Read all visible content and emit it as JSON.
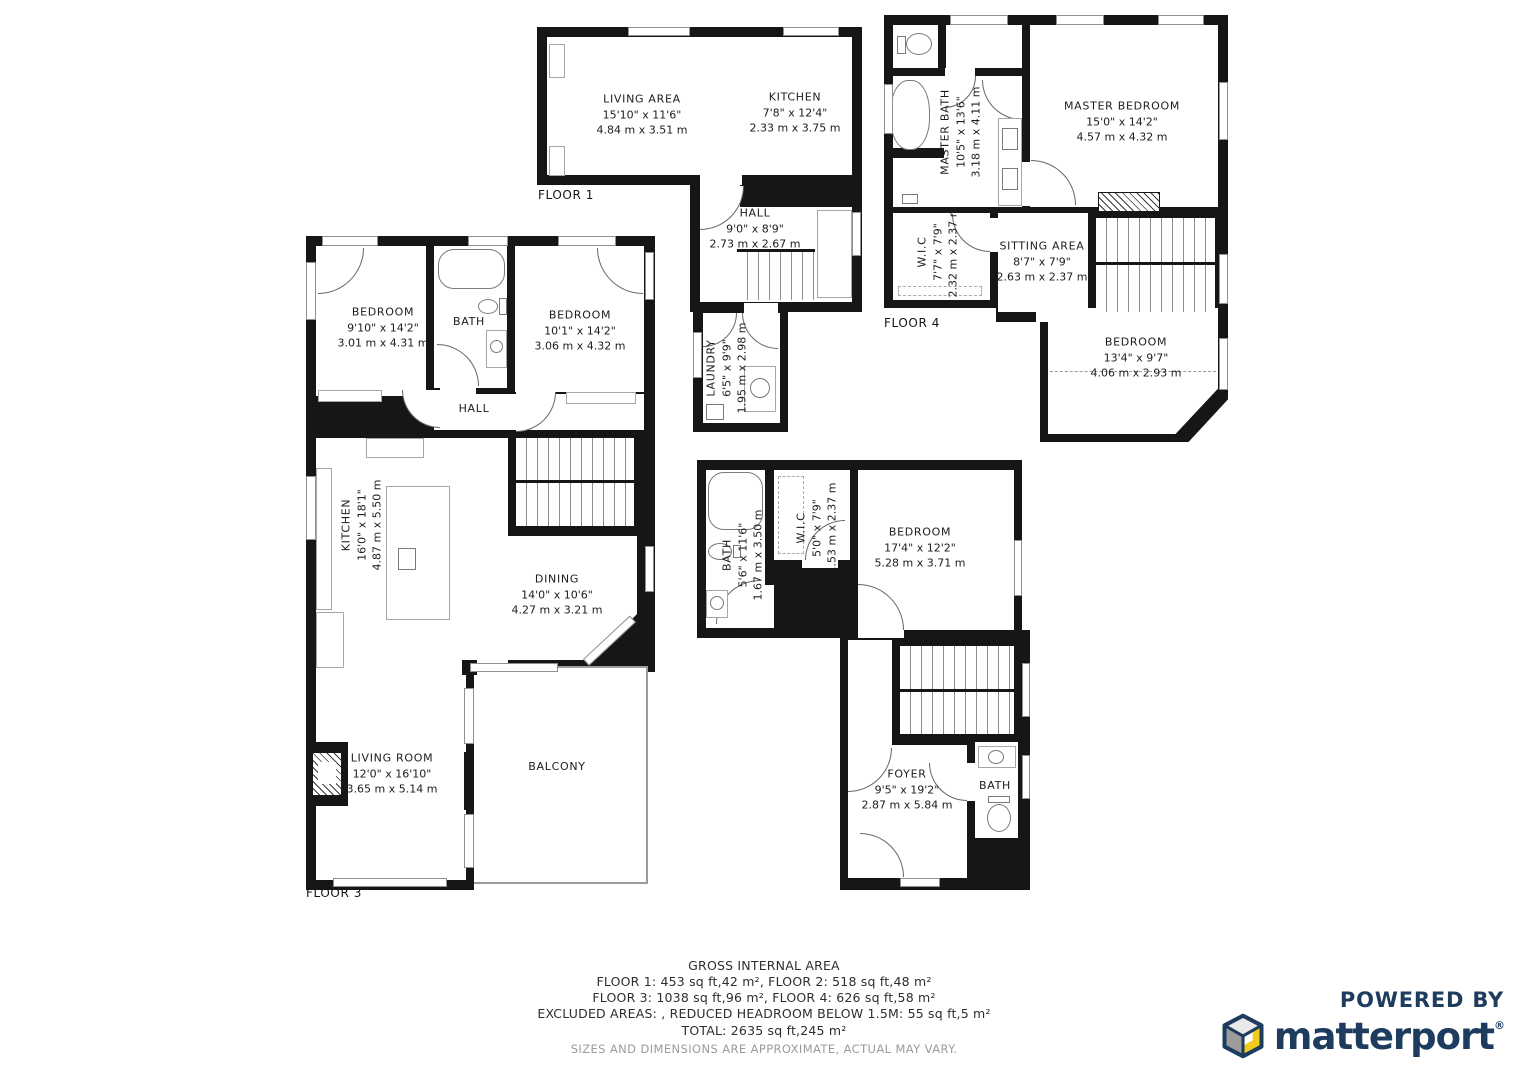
{
  "colors": {
    "wall": "#161616",
    "brand_navy": "#1d3c5e",
    "brand_yellow": "#f2cb1d"
  },
  "floor_labels": {
    "f1": "FLOOR 1",
    "f2": "FLOOR 2",
    "f3": "FLOOR 3",
    "f4": "FLOOR 4"
  },
  "rooms": {
    "f1_living": {
      "name": "LIVING AREA",
      "ft": "15'10\" x 11'6\"",
      "m": "4.84 m x 3.51 m"
    },
    "f1_kitchen": {
      "name": "KITCHEN",
      "ft": "7'8\" x 12'4\"",
      "m": "2.33 m x 3.75 m"
    },
    "f1_hall": {
      "name": "HALL",
      "ft": "9'0\" x 8'9\"",
      "m": "2.73 m x 2.67 m"
    },
    "f1_laundry": {
      "name": "LAUNDRY",
      "ft": "6'5\" x 9'9\"",
      "m": "1.95 m x 2.98 m"
    },
    "f2_bath": {
      "name": "BATH",
      "ft": "5'6\" x 11'6\"",
      "m": "1.67 m x 3.50 m"
    },
    "f2_wic": {
      "name": "W.I.C",
      "ft": "5'0\" x 7'9\"",
      "m": "1.53 m x 2.37 m"
    },
    "f2_bedroom": {
      "name": "BEDROOM",
      "ft": "17'4\" x 12'2\"",
      "m": "5.28 m x 3.71 m"
    },
    "f2_foyer": {
      "name": "FOYER",
      "ft": "9'5\" x 19'2\"",
      "m": "2.87 m x 5.84 m"
    },
    "f2_bath2": {
      "name": "BATH"
    },
    "f3_bedroom1": {
      "name": "BEDROOM",
      "ft": "9'10\" x 14'2\"",
      "m": "3.01 m x 4.31 m"
    },
    "f3_bath": {
      "name": "BATH"
    },
    "f3_bedroom2": {
      "name": "BEDROOM",
      "ft": "10'1\" x 14'2\"",
      "m": "3.06 m x 4.32 m"
    },
    "f3_hall": {
      "name": "HALL"
    },
    "f3_kitchen": {
      "name": "KITCHEN",
      "ft": "16'0\" x 18'1\"",
      "m": "4.87 m x 5.50 m"
    },
    "f3_dining": {
      "name": "DINING",
      "ft": "14'0\" x 10'6\"",
      "m": "4.27 m x 3.21 m"
    },
    "f3_living": {
      "name": "LIVING ROOM",
      "ft": "12'0\" x 16'10\"",
      "m": "3.65 m x 5.14 m"
    },
    "f3_balcony": {
      "name": "BALCONY"
    },
    "f4_mbath": {
      "name": "MASTER BATH",
      "ft": "10'5\" x 13'6\"",
      "m": "3.18 m x 4.11 m"
    },
    "f4_mbed": {
      "name": "MASTER BEDROOM",
      "ft": "15'0\" x 14'2\"",
      "m": "4.57 m x 4.32 m"
    },
    "f4_wic": {
      "name": "W.I.C",
      "ft": "7'7\" x 7'9\"",
      "m": "2.32 m x 2.37 m"
    },
    "f4_sitting": {
      "name": "SITTING AREA",
      "ft": "8'7\" x 7'9\"",
      "m": "2.63 m x 2.37 m"
    },
    "f4_bedroom": {
      "name": "BEDROOM",
      "ft": "13'4\" x 9'7\"",
      "m": "4.06 m x 2.93 m"
    }
  },
  "summary": {
    "title": "GROSS INTERNAL AREA",
    "line1": "FLOOR 1: 453 sq ft,42 m², FLOOR 2: 518 sq ft,48 m²",
    "line2": "FLOOR 3: 1038 sq ft,96 m², FLOOR 4: 626 sq ft,58 m²",
    "line3": "EXCLUDED AREAS: , REDUCED HEADROOM BELOW 1.5M: 55 sq ft,5 m²",
    "line4": "TOTAL: 2635 sq ft,245 m²",
    "disclaimer": "SIZES AND DIMENSIONS ARE APPROXIMATE, ACTUAL MAY VARY."
  },
  "branding": {
    "powered_by": "POWERED BY",
    "brand": "matterport",
    "reg": "®"
  }
}
